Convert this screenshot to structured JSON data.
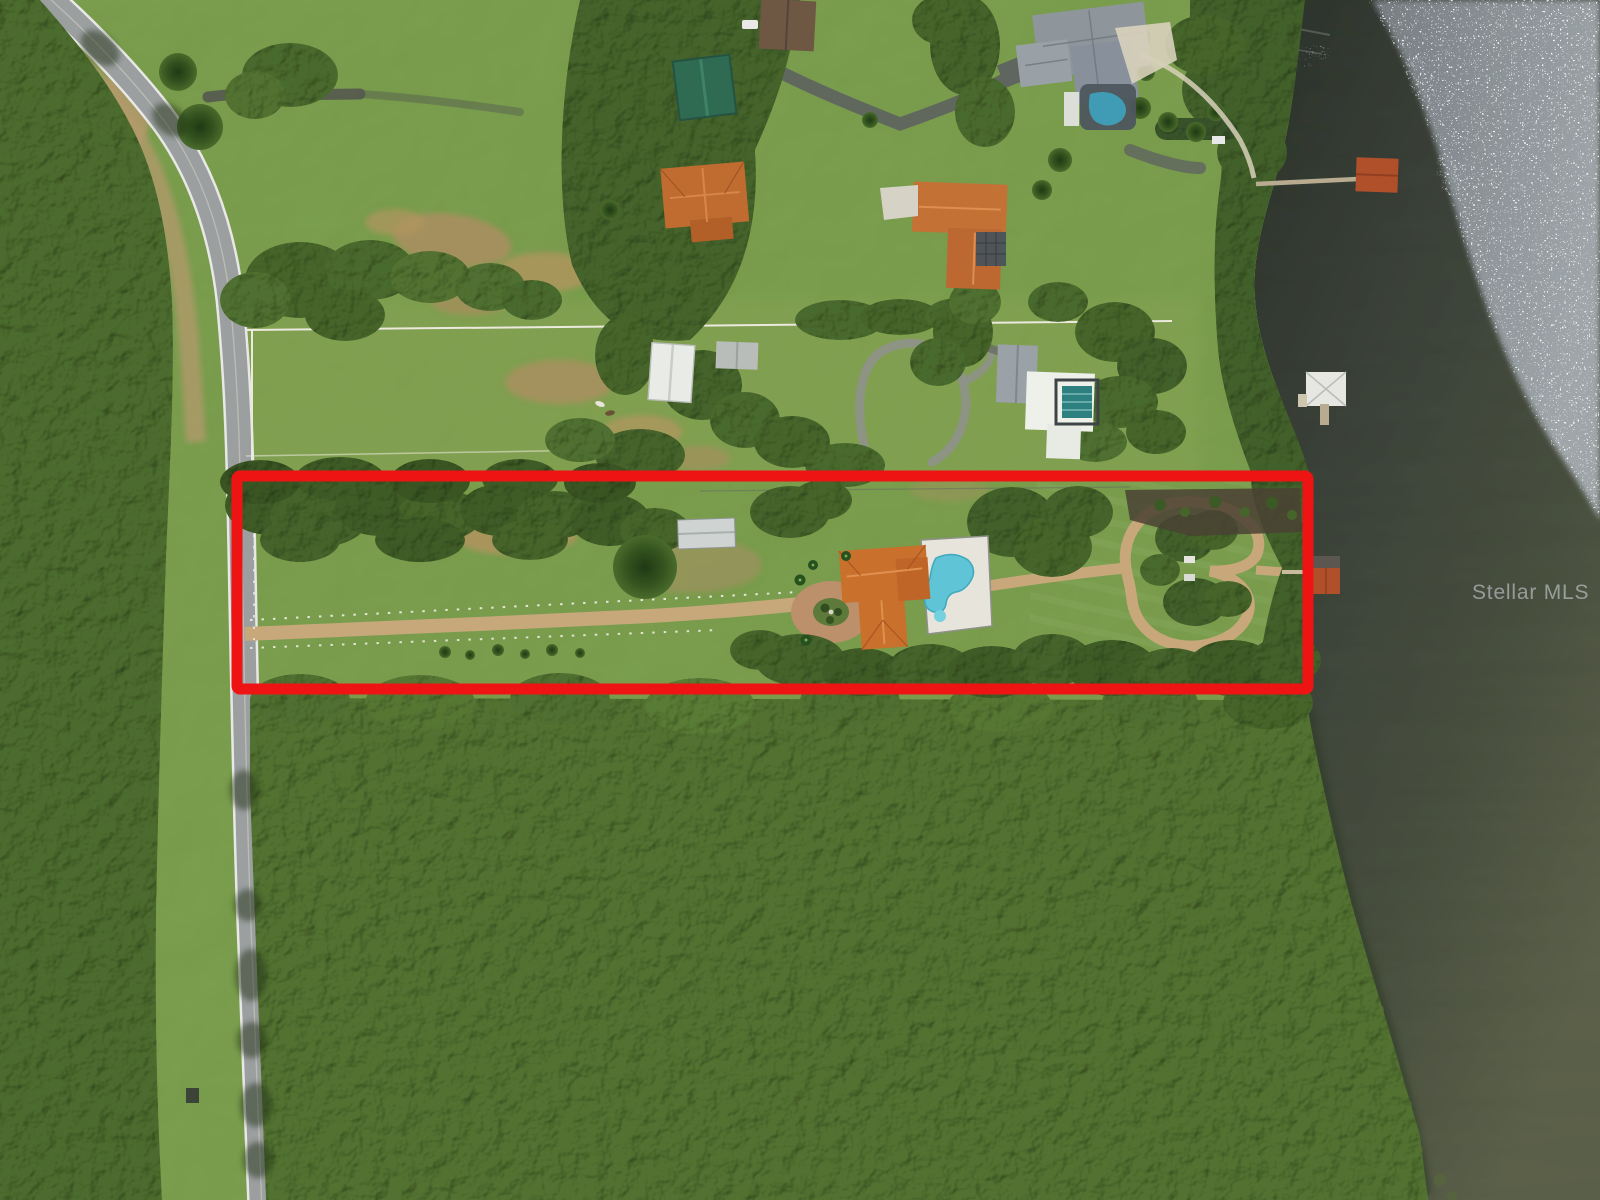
{
  "image": {
    "kind": "aerial-drone-photograph",
    "subject": "Lakefront estate with red-outlined property parcel",
    "orientation": "top-down"
  },
  "watermark": {
    "text": "Stellar MLS",
    "color": "#c9ced4"
  },
  "annotation": {
    "label": "property-boundary",
    "shape": "rectangle",
    "color": "#ee1414"
  },
  "palette": {
    "lawn_green": "#7da24f",
    "pasture_green": "#8aa355",
    "forest_green": "#4d6d2e",
    "water_dark": "#343b31",
    "water_light": "#5c614b",
    "sun_glint": "#d9dde2",
    "road_gray": "#9b9fa0",
    "asphalt_drive": "#5f655f",
    "dirt_drive_tan": "#c6a87b",
    "bare_dirt": "#ab8e60",
    "clay_roof_orange": "#c9702d",
    "slate_roof_gray": "#8e969b",
    "metal_roof_green": "#2e6b52",
    "metal_roof_white": "#e9ebe7",
    "pool_water": "#5ec4d6",
    "lap_pool_water": "#2e7f80",
    "boathouse_roof": "#b0502b",
    "fence_white": "#eceadf"
  },
  "features": {
    "parcel": [
      "tree-lined north border",
      "long straight fenced driveway",
      "orange tile roof residence",
      "free-form pool with white deck",
      "circular motor court with island",
      "lakeside loop path",
      "boat dock with boathouse"
    ],
    "surroundings": [
      "curving two-lane road",
      "gray roof mansion with screened pool",
      "two orange tile roof houses",
      "white barn",
      "green roof barn",
      "white house with lap pool",
      "horse pasture with white fencing",
      "dense woodland",
      "lake with sun glint",
      "boat docks"
    ]
  }
}
